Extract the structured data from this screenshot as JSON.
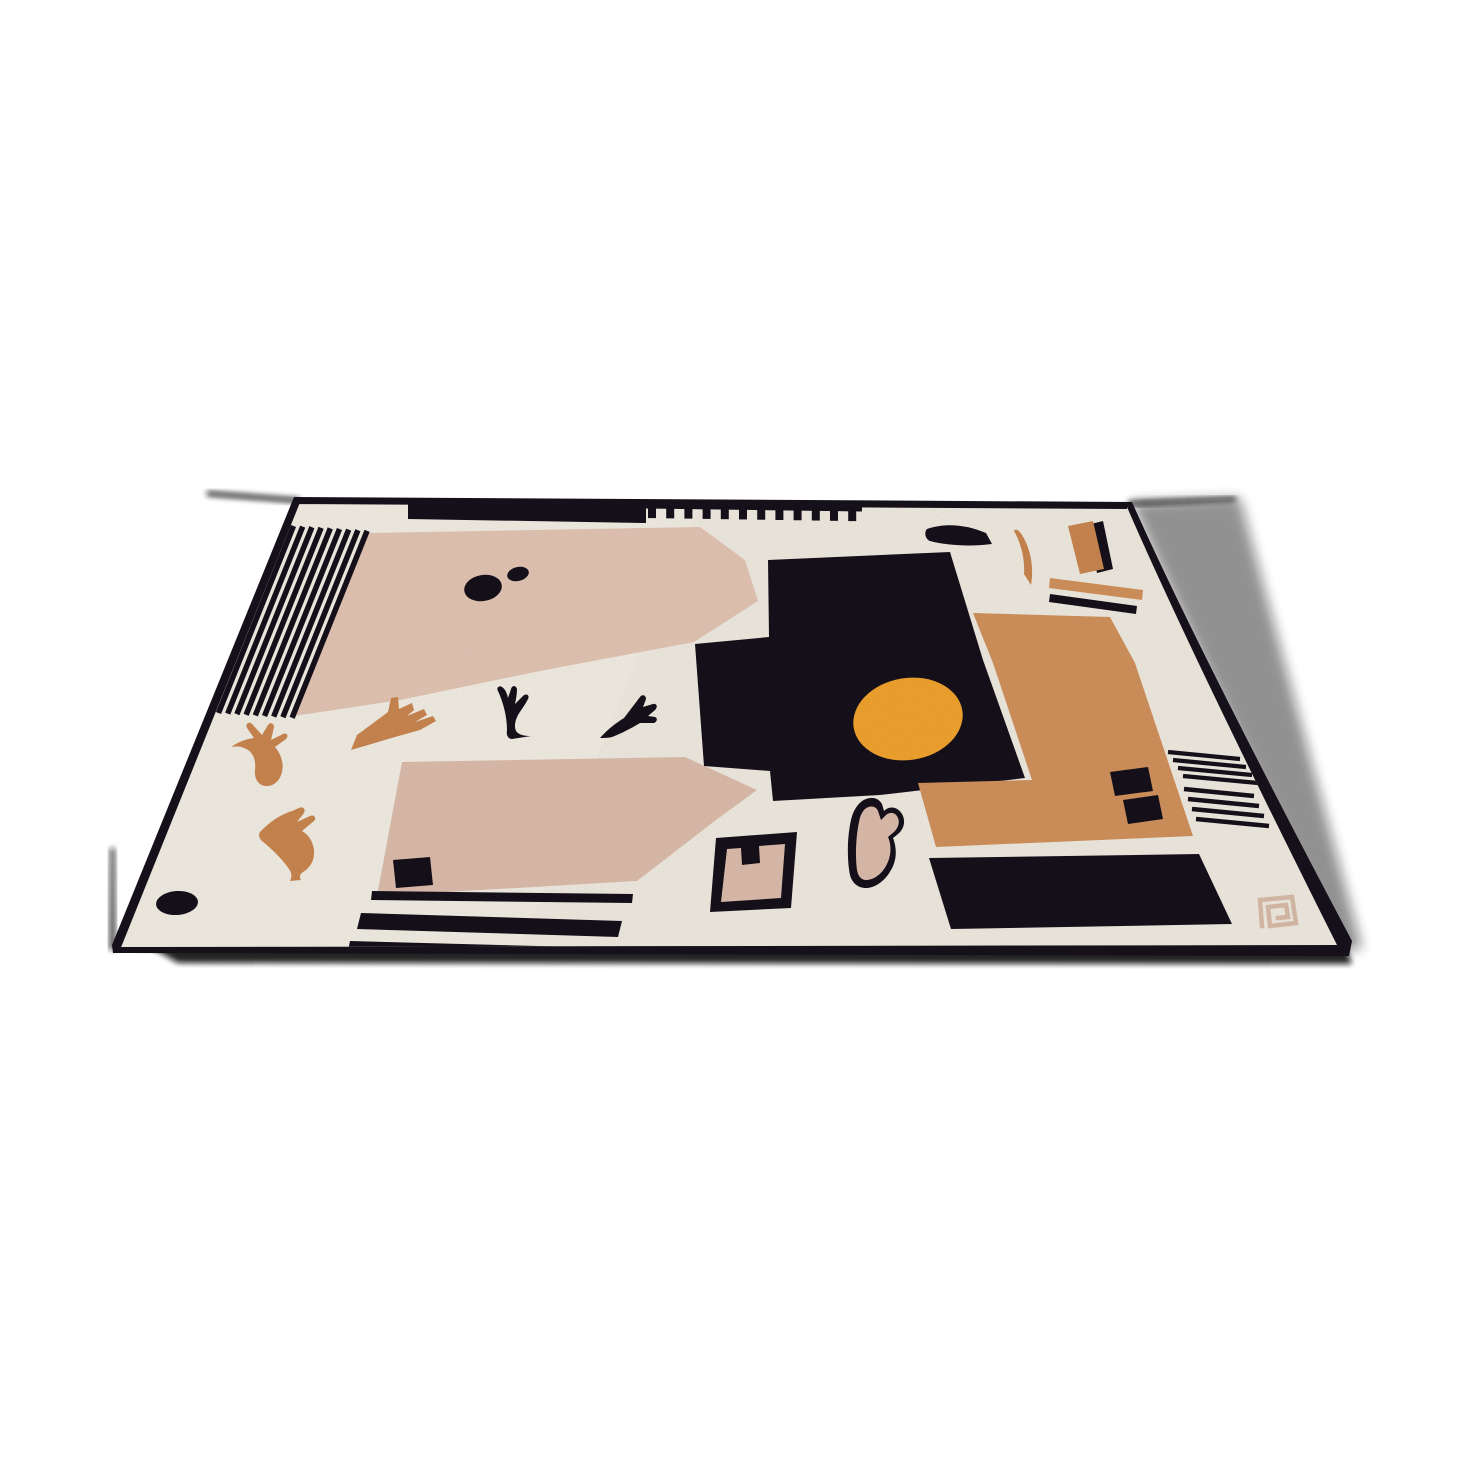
{
  "image": {
    "subject": "Abstract modernist hand-tufted wool area rug photographed in perspective on a plain white background",
    "style": "cubist color-block composition with stripes, organic motifs and a sun disc",
    "view": "three-quarter floor perspective, front edge nearest"
  },
  "colors": {
    "background": "#ffffff",
    "rug_cream": "#efeae0",
    "rug_cream_bright": "#f3efe6",
    "ink_black": "#15101a",
    "blush": "#e3c4b3",
    "blush_deep": "#dcbcab",
    "caramel": "#d0915c",
    "orange": "#f0a22e",
    "motif_orange": "#c9854f",
    "logo_beige": "#d7bba7",
    "shadow": "#0b0a0b"
  },
  "pattern": {
    "top_left_stripes": 9,
    "comb_teeth": 12,
    "right_stripes_upper": 4,
    "right_stripes_lower": 4
  },
  "motifs": [
    "diagonal stripe field (top-left)",
    "solid top bar with comb fringe",
    "upper blush field with two ink dots",
    "black stepped field with orange sun disc",
    "caramel color-block with two ink squares",
    "bottom-right ink band",
    "lower blush trapezoid with ink square and base stripes",
    "orange bird-foot sprigs",
    "black bird silhouettes",
    "outlined notched tile and tulip pebble",
    "fin and crescent accents (top-right)",
    "horizontal margin stripes (right edge)",
    "greek-key maker mark (bottom-right corner)"
  ]
}
